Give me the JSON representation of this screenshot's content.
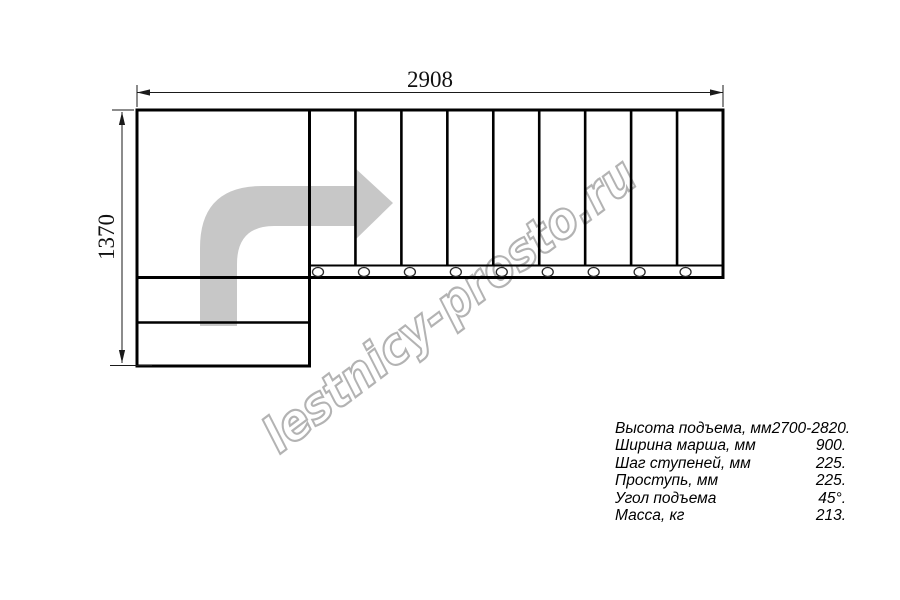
{
  "watermark": {
    "text": "lestnicy-prosto.ru",
    "outline_color": "#b3b3b3"
  },
  "dimensions": {
    "top": "2908",
    "left": "1370"
  },
  "drawing": {
    "type": "L-shaped staircase plan view",
    "run_step_count": 9,
    "lower_step_count": 2,
    "line_color": "#000000",
    "arrow_color": "#c7c7c7"
  },
  "specs": {
    "rows": [
      {
        "label": "Высота подъема, мм",
        "value": "2700-2820."
      },
      {
        "label": "Ширина марша, мм",
        "value": "900."
      },
      {
        "label": "Шаг ступеней, мм",
        "value": "225."
      },
      {
        "label": "Проступь, мм",
        "value": "225."
      },
      {
        "label": "Угол подъема",
        "value": "45°."
      },
      {
        "label": "Масса, кг",
        "value": "213."
      }
    ]
  }
}
